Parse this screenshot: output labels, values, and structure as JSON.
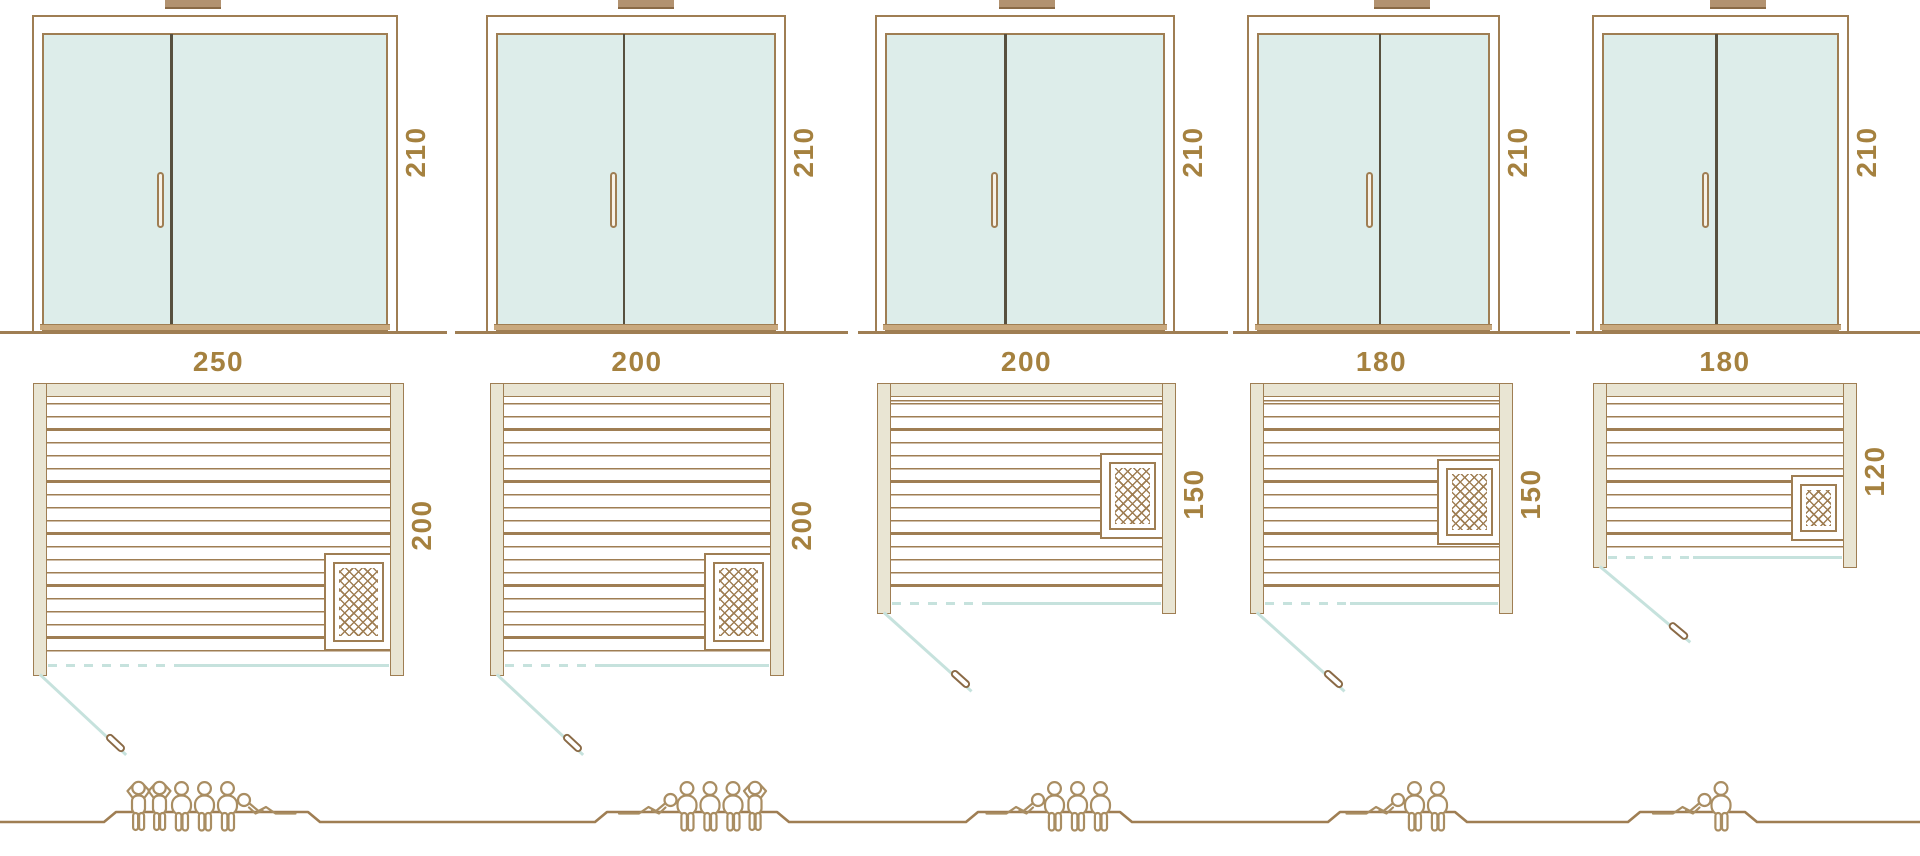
{
  "diagram": {
    "title": "Sauna size comparison diagram",
    "views": [
      "front-elevation",
      "floor-plan",
      "seating-capacity"
    ],
    "door_height_cm": "210",
    "saunas": [
      {
        "name": "250 x 200",
        "width_label": "250",
        "depth_label": "200",
        "height_label": "210",
        "heater": true,
        "capacity": 6,
        "people": [
          "standing",
          "standing",
          "sitting",
          "sitting",
          "sitting",
          "lying-right"
        ]
      },
      {
        "name": "200 x 200",
        "width_label": "200",
        "depth_label": "200",
        "height_label": "210",
        "heater": true,
        "capacity": 5,
        "people": [
          "lying",
          "sitting",
          "sitting",
          "sitting",
          "standing"
        ]
      },
      {
        "name": "200 x 150",
        "width_label": "200",
        "depth_label": "150",
        "height_label": "210",
        "heater": true,
        "capacity": 4,
        "people": [
          "lying",
          "sitting",
          "sitting",
          "sitting"
        ]
      },
      {
        "name": "180 x 150",
        "width_label": "180",
        "depth_label": "150",
        "height_label": "210",
        "heater": true,
        "capacity": 3,
        "people": [
          "lying",
          "sitting",
          "sitting"
        ]
      },
      {
        "name": "180 x 120",
        "width_label": "180",
        "depth_label": "120",
        "height_label": "210",
        "heater": true,
        "capacity": 2,
        "people": [
          "lying",
          "sitting"
        ]
      }
    ],
    "colors": {
      "line_brown": "#9f7e53",
      "label_brown": "#a5813f",
      "wall_beige": "#e9e5d3",
      "glass_teal": "#ddedea",
      "swing_teal": "#c6e2dd",
      "divider_dark": "#57503f",
      "cap_tan": "#b29270",
      "sill_tan": "#c9a97e",
      "people_tan": "#a98d62"
    }
  }
}
